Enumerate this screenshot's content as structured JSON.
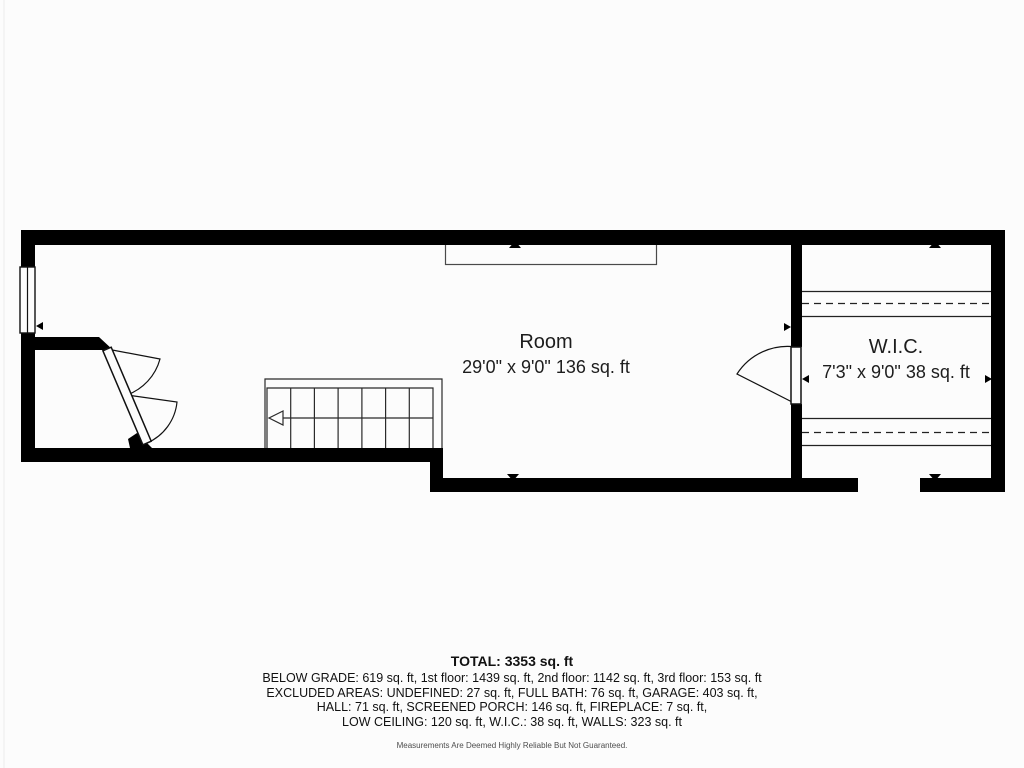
{
  "rooms": [
    {
      "name": "Room",
      "dims": "29'0\" x 9'0\" 136 sq. ft"
    },
    {
      "name": "W.I.C.",
      "dims": "7'3\" x 9'0\" 38 sq. ft"
    }
  ],
  "summary": {
    "total": "TOTAL: 3353 sq. ft",
    "lines": [
      "BELOW GRADE: 619 sq. ft, 1st floor: 1439 sq. ft, 2nd floor: 1142 sq. ft, 3rd floor: 153 sq. ft",
      "EXCLUDED AREAS: UNDEFINED: 27 sq. ft, FULL BATH: 76 sq. ft, GARAGE: 403 sq. ft,",
      "HALL: 71 sq. ft, SCREENED PORCH: 146 sq. ft, FIREPLACE: 7 sq. ft,",
      "LOW CEILING: 120 sq. ft, W.I.C.: 38 sq. ft, WALLS: 323 sq. ft"
    ],
    "disclaimer": "Measurements Are Deemed Highly Reliable But Not Guaranteed."
  },
  "colors": {
    "wall": "#000000",
    "line": "#2a2a2a",
    "text": "#1d1d1d",
    "disclaimer_text": "#4d4d4d",
    "background": "#fcfcfc"
  }
}
